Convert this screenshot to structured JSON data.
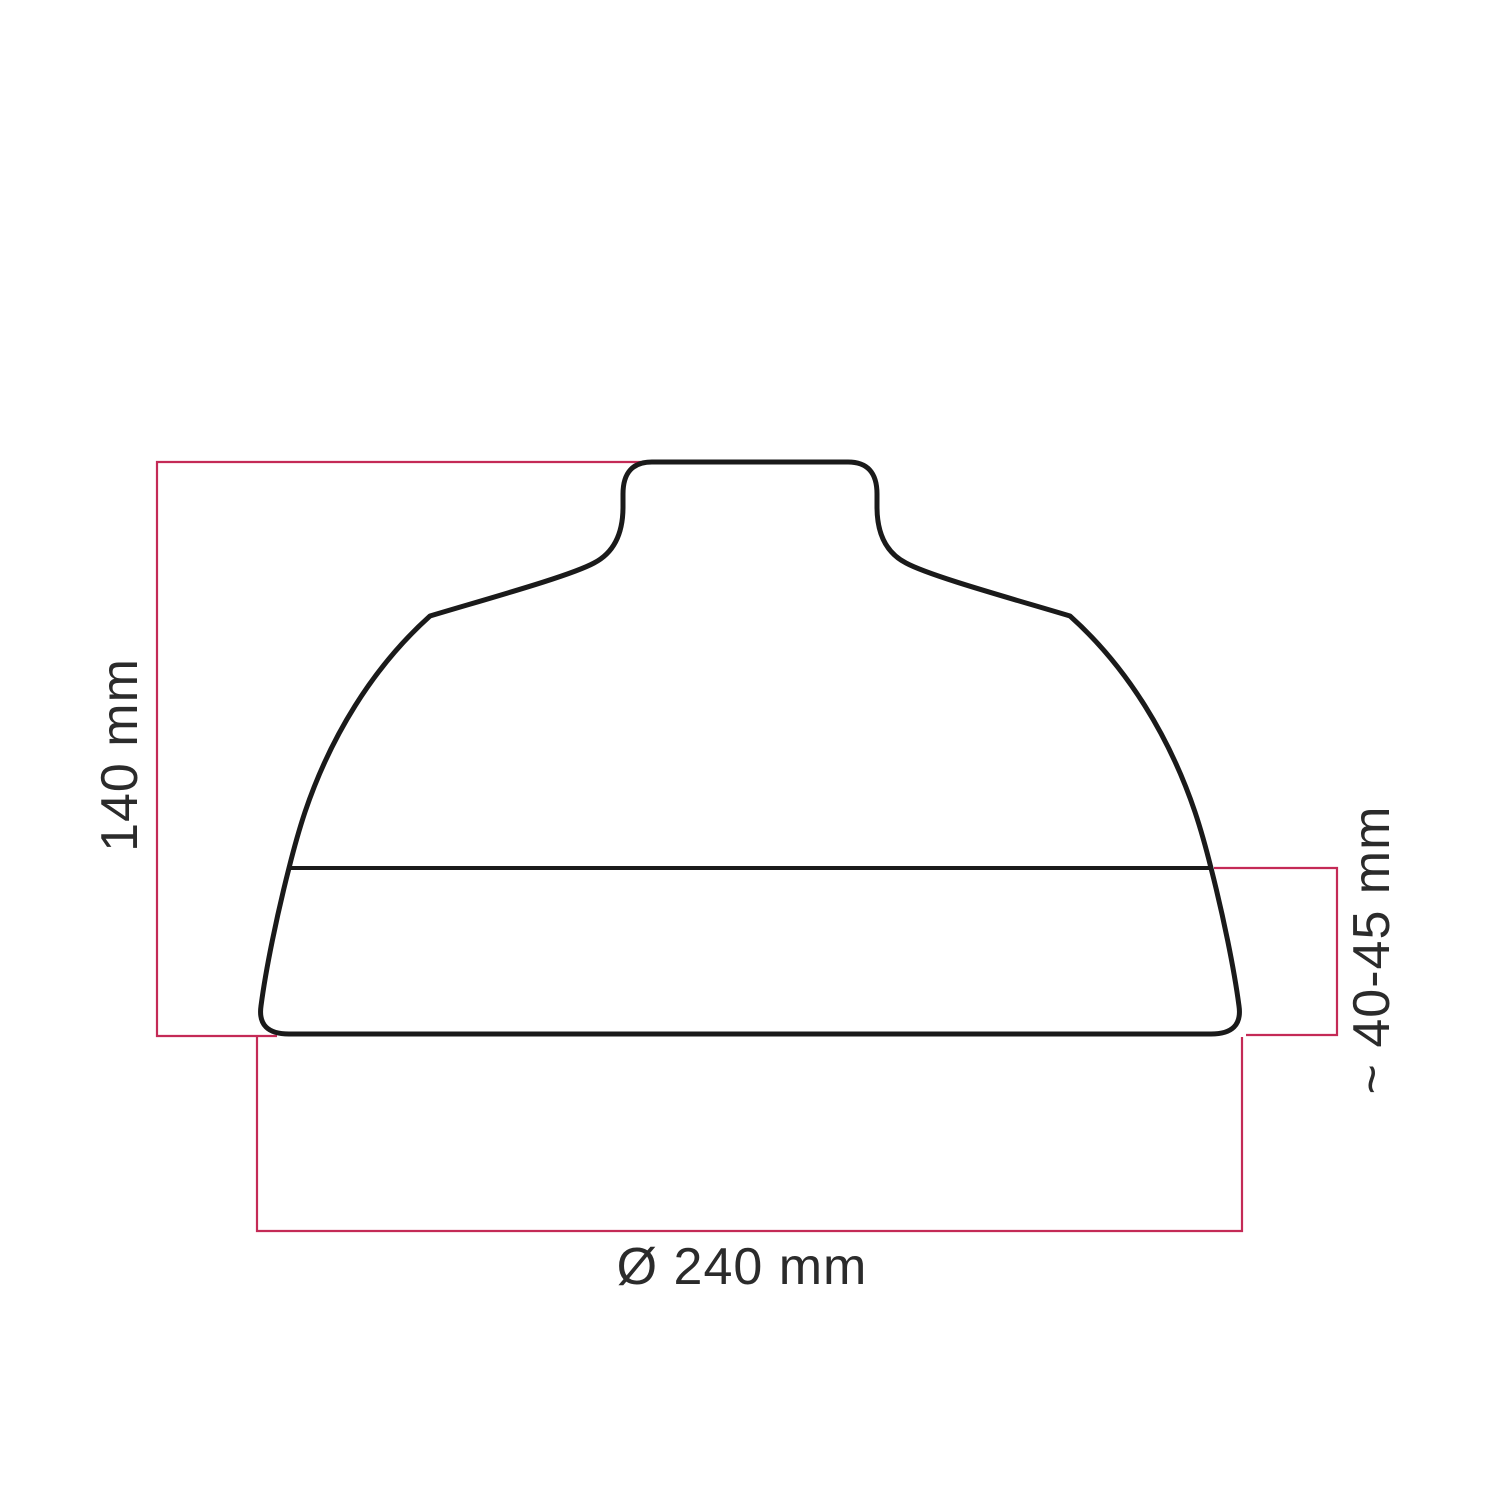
{
  "colors": {
    "dimension_line": "#c42a56",
    "outline": "#1a1a1a",
    "label_text": "#2b2b2b",
    "background": "#ffffff"
  },
  "labels": {
    "height": "140 mm",
    "side_height": "~ 40-45 mm",
    "diameter": "Ø 240 mm"
  }
}
